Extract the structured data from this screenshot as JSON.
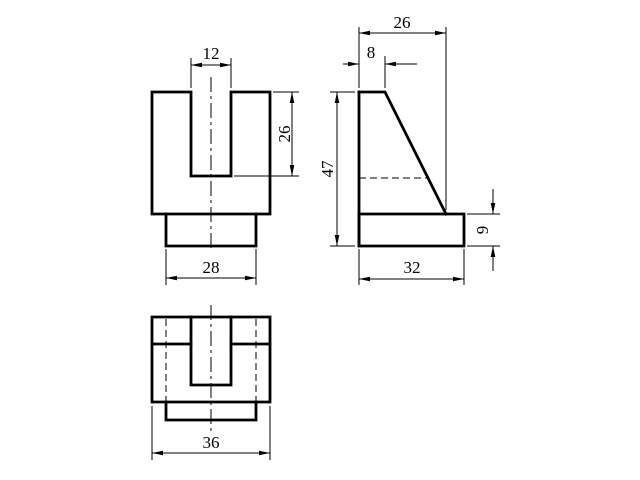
{
  "drawing": {
    "description": "Orthographic projection drawing, three views of a bracket with U-slot",
    "canvas": {
      "width": 640,
      "height": 480,
      "background": "#ffffff",
      "line_color": "#000000"
    },
    "views": [
      {
        "name": "front-view",
        "thick": [
          "M152,92 L191,92 L191,176 L231,176 L231,92 L270,92 L270,214 L256,214 L256,246 L166,246 L166,214 L152,214 Z",
          "M166,214 L256,214"
        ],
        "dashed": [],
        "centerlines": [
          "M211,77 L211,252"
        ]
      },
      {
        "name": "side-view",
        "thick": [
          "M359,92 L385,92 L446,214",
          "M359,214 L464,214 L464,246 L359,246 Z",
          "M359,92 L359,246"
        ],
        "dashed": [
          "M359,178 L429,178"
        ],
        "centerlines": []
      },
      {
        "name": "bottom-view",
        "thick": [
          "M152,317 L270,317 L270,402 L152,402 Z",
          "M191,317 L191,385 L231,385 L231,317",
          "M152,344 L191,344",
          "M231,344 L270,344",
          "M166,402 L166,420 L256,420 L256,402"
        ],
        "dashed": [
          "M166,319 L166,402",
          "M256,319 L256,402"
        ],
        "centerlines": [
          "M211,305 L211,431"
        ]
      }
    ],
    "dimensions": [
      {
        "label": "12",
        "view": "front-view",
        "value": 12,
        "ext": [
          "M191,88 L191,58",
          "M231,88 L231,58"
        ],
        "lines": [
          "M191,65 L231,65"
        ],
        "arrows": [
          {
            "tip": [
              191,
              65
            ],
            "dir": "left"
          },
          {
            "tip": [
              231,
              65
            ],
            "dir": "right"
          }
        ],
        "text": {
          "x": 211,
          "y": 59,
          "rotate": 0
        }
      },
      {
        "label": "26",
        "view": "front-view",
        "value": 26,
        "ext": [
          "M273,92 L299,92",
          "M234,176 L299,176"
        ],
        "lines": [
          "M292,92 L292,176"
        ],
        "arrows": [
          {
            "tip": [
              292,
              92
            ],
            "dir": "up"
          },
          {
            "tip": [
              292,
              176
            ],
            "dir": "down"
          }
        ],
        "text": {
          "x": 290,
          "y": 134,
          "rotate": -90
        }
      },
      {
        "label": "28",
        "view": "front-view",
        "value": 28,
        "ext": [
          "M166,249 L166,285",
          "M256,249 L256,285"
        ],
        "lines": [
          "M166,278 L256,278"
        ],
        "arrows": [
          {
            "tip": [
              166,
              278
            ],
            "dir": "left"
          },
          {
            "tip": [
              256,
              278
            ],
            "dir": "right"
          }
        ],
        "text": {
          "x": 211,
          "y": 273,
          "rotate": 0
        }
      },
      {
        "label": "26",
        "view": "side-view",
        "value": 26,
        "ext": [
          "M359,88 L359,27",
          "M446,210 L446,27"
        ],
        "lines": [
          "M359,33 L446,33"
        ],
        "arrows": [
          {
            "tip": [
              359,
              33
            ],
            "dir": "left"
          },
          {
            "tip": [
              446,
              33
            ],
            "dir": "right"
          }
        ],
        "text": {
          "x": 402,
          "y": 28,
          "rotate": 0
        }
      },
      {
        "label": "8",
        "view": "side-view",
        "value": 8,
        "ext": [
          "M385,88 L385,56"
        ],
        "lines": [
          "M343,64 L359,64",
          "M385,64 L417,64"
        ],
        "arrows": [
          {
            "tip": [
              359,
              64
            ],
            "dir": "right"
          },
          {
            "tip": [
              385,
              64
            ],
            "dir": "left"
          }
        ],
        "text": {
          "x": 371,
          "y": 58,
          "rotate": 0
        }
      },
      {
        "label": "47",
        "view": "side-view",
        "value": 47,
        "ext": [
          "M355,92 L330,92",
          "M355,246 L330,246"
        ],
        "lines": [
          "M337,92 L337,246"
        ],
        "arrows": [
          {
            "tip": [
              337,
              92
            ],
            "dir": "up"
          },
          {
            "tip": [
              337,
              246
            ],
            "dir": "down"
          }
        ],
        "text": {
          "x": 333,
          "y": 169,
          "rotate": -90
        }
      },
      {
        "label": "32",
        "view": "side-view",
        "value": 32,
        "ext": [
          "M359,249 L359,285",
          "M464,249 L464,285"
        ],
        "lines": [
          "M359,279 L464,279"
        ],
        "arrows": [
          {
            "tip": [
              359,
              279
            ],
            "dir": "left"
          },
          {
            "tip": [
              464,
              279
            ],
            "dir": "right"
          }
        ],
        "text": {
          "x": 412,
          "y": 273,
          "rotate": 0
        }
      },
      {
        "label": "9",
        "view": "side-view",
        "value": 9,
        "ext": [
          "M467,214 L500,214",
          "M467,246 L500,246"
        ],
        "lines": [
          "M493,189 L493,214",
          "M493,246 L493,271"
        ],
        "arrows": [
          {
            "tip": [
              493,
              214
            ],
            "dir": "down"
          },
          {
            "tip": [
              493,
              246
            ],
            "dir": "up"
          }
        ],
        "text": {
          "x": 488,
          "y": 230,
          "rotate": -90
        }
      },
      {
        "label": "36",
        "view": "bottom-view",
        "value": 36,
        "ext": [
          "M152,406 L152,460",
          "M270,406 L270,460"
        ],
        "lines": [
          "M152,453 L270,453"
        ],
        "arrows": [
          {
            "tip": [
              152,
              453
            ],
            "dir": "left"
          },
          {
            "tip": [
              270,
              453
            ],
            "dir": "right"
          }
        ],
        "text": {
          "x": 211,
          "y": 448,
          "rotate": 0
        }
      }
    ]
  }
}
